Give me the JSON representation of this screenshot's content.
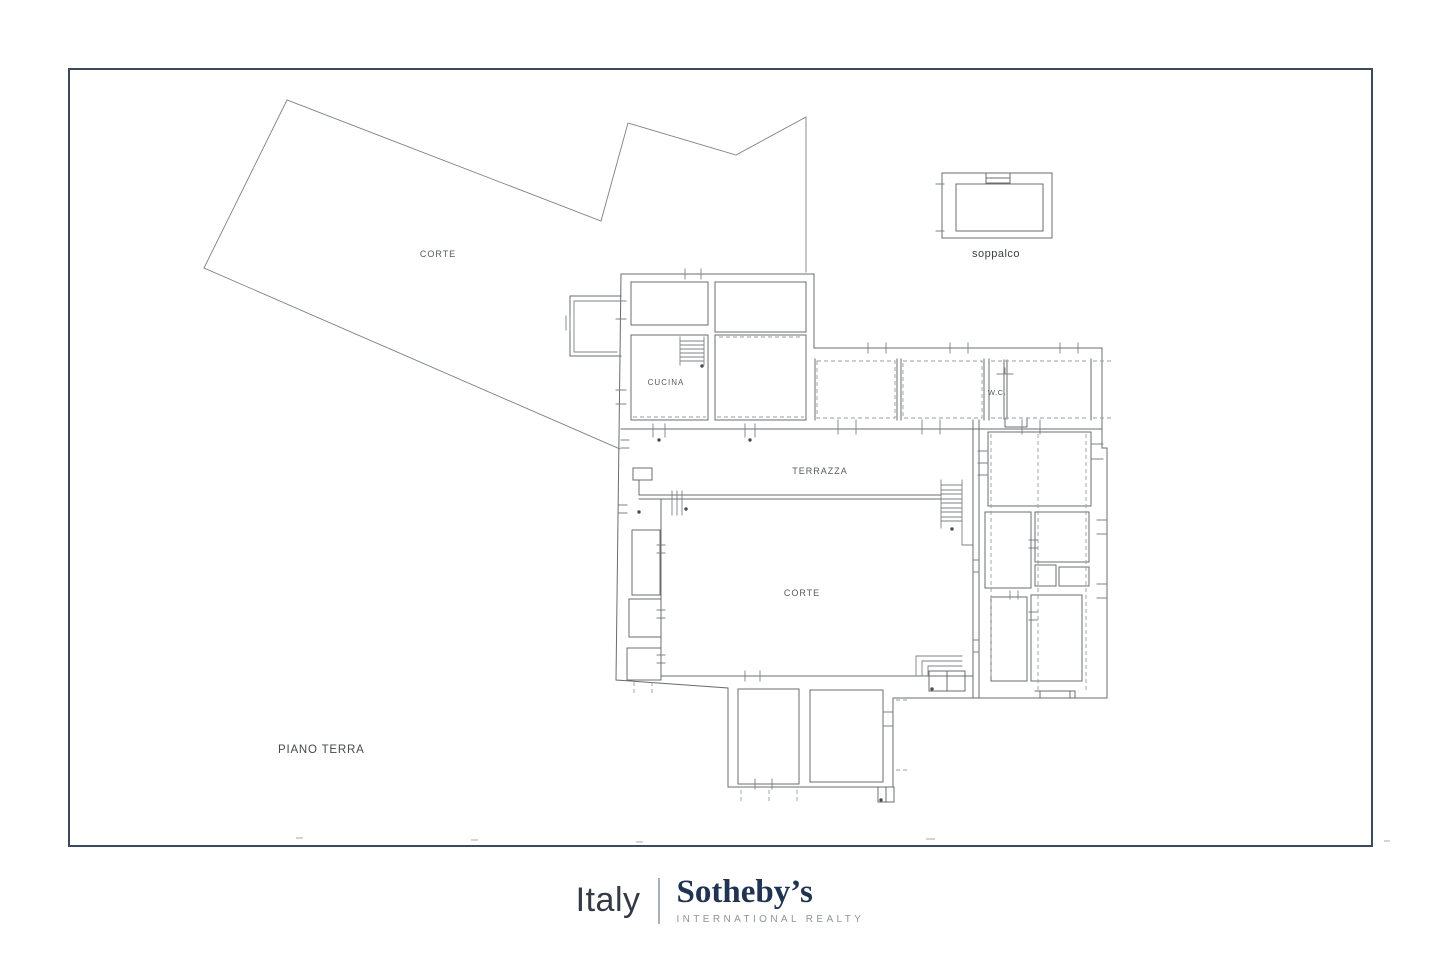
{
  "page": {
    "background": "#ffffff"
  },
  "frame": {
    "border_color": "#3d4a5c"
  },
  "plan": {
    "labels": {
      "corte_large": "CORTE",
      "cucina": "CUCINA",
      "terrazza": "TERRAZZA",
      "wc": "W.C.",
      "corte_courtyard": "CORTE",
      "soppalco": "soppalco",
      "piano_terra": "PIANO TERRA"
    },
    "colors": {
      "wall": "#686c70",
      "dashed": "#979ca0",
      "label": "#55595e"
    }
  },
  "branding": {
    "country": "Italy",
    "brand": "Sotheby’s",
    "subtitle": "INTERNATIONAL REALTY",
    "colors": {
      "country": "#343a44",
      "brand": "#203451",
      "subtitle": "#8e949c",
      "divider": "#a9b0b7"
    }
  }
}
